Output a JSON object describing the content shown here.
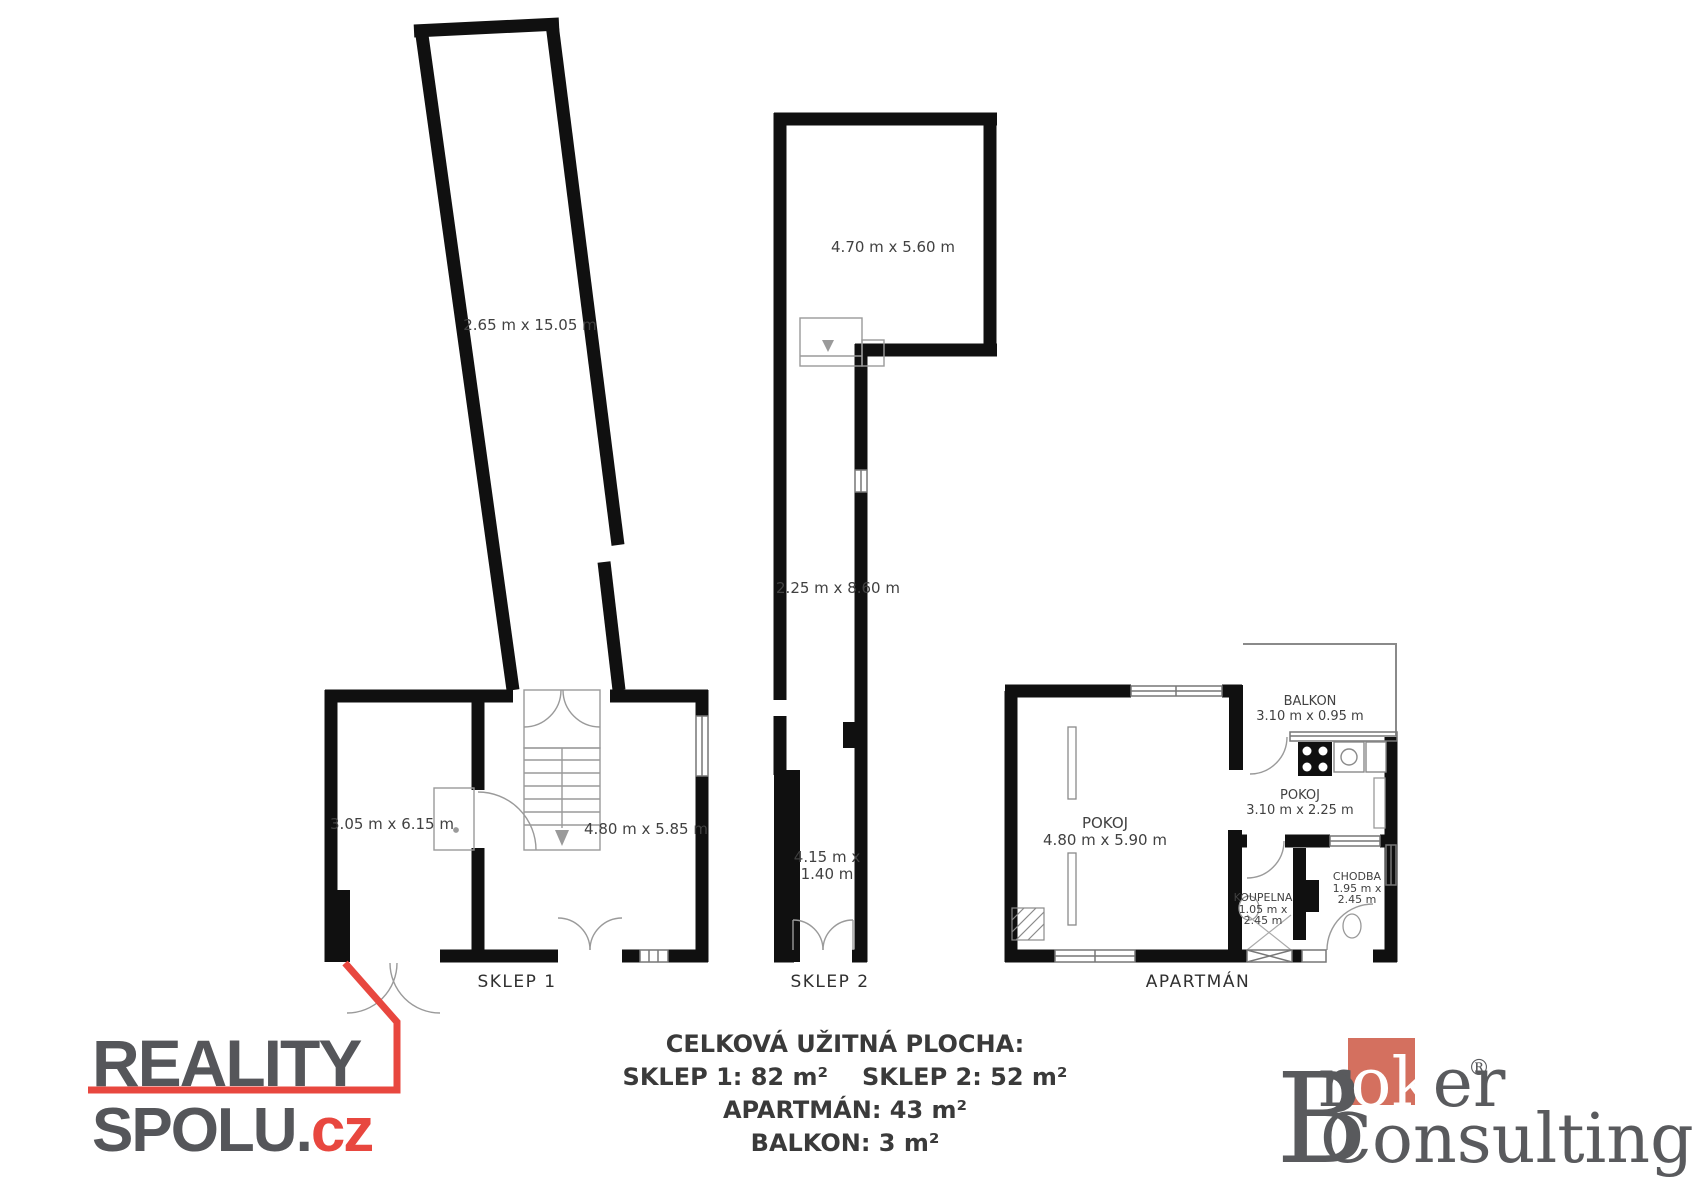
{
  "plans": {
    "sklep1": {
      "caption": "SKLEP 1",
      "corridor_dims": "2.65 m x 15.05 m",
      "left_room_dims": "3.05 m x 6.15 m",
      "right_room_dims": "4.80 m x 5.85 m"
    },
    "sklep2": {
      "caption": "SKLEP 2",
      "top_room_dims": "4.70 m x 5.60 m",
      "corridor_dims": "2.25 m x 8.60 m",
      "narrow_dims_l1": "4.15 m x",
      "narrow_dims_l2": "1.40 m"
    },
    "apartman": {
      "caption": "APARTMÁN",
      "balkon_name": "BALKON",
      "balkon_dims": "3.10 m x 0.95 m",
      "pokoj_main_name": "POKOJ",
      "pokoj_main_dims": "4.80 m x 5.90 m",
      "pokoj2_name": "POKOJ",
      "pokoj2_dims": "3.10 m x 2.25 m",
      "koupelna_name": "KOUPELNA",
      "koupelna_dims_l1": "1.05 m x",
      "koupelna_dims_l2": "2.45 m",
      "chodba_name": "CHODBA",
      "chodba_dims_l1": "1.95 m x",
      "chodba_dims_l2": "2.45 m"
    }
  },
  "summary": {
    "title": "CELKOVÁ UŽITNÁ PLOCHA:",
    "sklep1": "SKLEP 1: 82 m²",
    "sklep2": "SKLEP 2: 52 m²",
    "apartman": "APARTMÁN: 43 m²",
    "balkon": "BALKON: 3 m²"
  },
  "logos": {
    "reality_spolu": {
      "line1": "REALITY",
      "line2_main": "SPOLU.",
      "line2_suffix": "cz"
    },
    "broker_consulting": {
      "b": "B",
      "r": "r",
      "ok": "ok",
      "er": "er",
      "registered": "®",
      "line2": "Consulting"
    }
  },
  "colors": {
    "accent_red": "#e8473f",
    "broker_square": "#d4705f",
    "wall_black": "#101010",
    "text_dark": "#3a3a3a",
    "logo_gray": "#55565a"
  }
}
